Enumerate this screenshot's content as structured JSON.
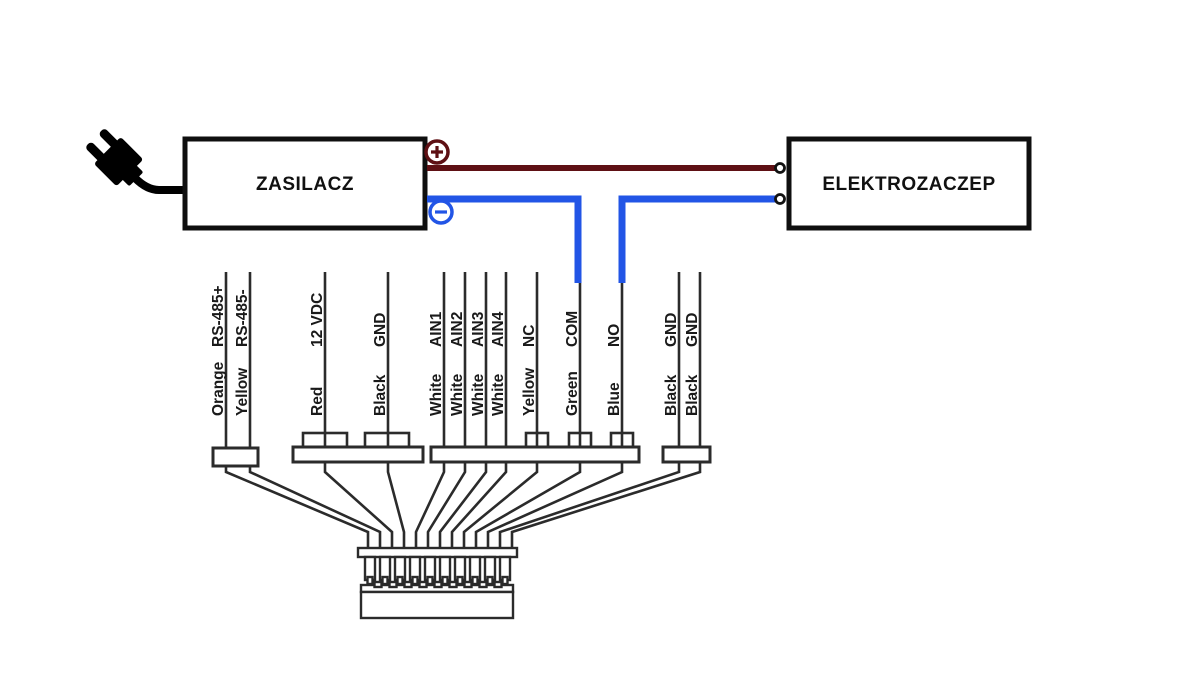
{
  "diagram": {
    "power_supply": {
      "label": "ZASILACZ"
    },
    "electric_strike": {
      "label": "ELEKTROZACZEP"
    },
    "polarity": {
      "positive": "+",
      "negative": "−"
    },
    "colors": {
      "positive_wire": "#5e1014",
      "negative_wire": "#2255e6",
      "line": "#2b2b2b",
      "background": "#ffffff"
    },
    "wires": [
      {
        "signal": "RS-485+",
        "color": "Orange"
      },
      {
        "signal": "RS-485-",
        "color": "Yellow"
      },
      {
        "signal": "12 VDC",
        "color": "Red"
      },
      {
        "signal": "GND",
        "color": "Black"
      },
      {
        "signal": "AIN1",
        "color": "White"
      },
      {
        "signal": "AIN2",
        "color": "White"
      },
      {
        "signal": "AIN3",
        "color": "White"
      },
      {
        "signal": "AIN4",
        "color": "White"
      },
      {
        "signal": "NC",
        "color": "Yellow"
      },
      {
        "signal": "COM",
        "color": "Green"
      },
      {
        "signal": "NO",
        "color": "Blue"
      },
      {
        "signal": "GND",
        "color": "Black"
      },
      {
        "signal": "GND",
        "color": "Black"
      }
    ]
  }
}
